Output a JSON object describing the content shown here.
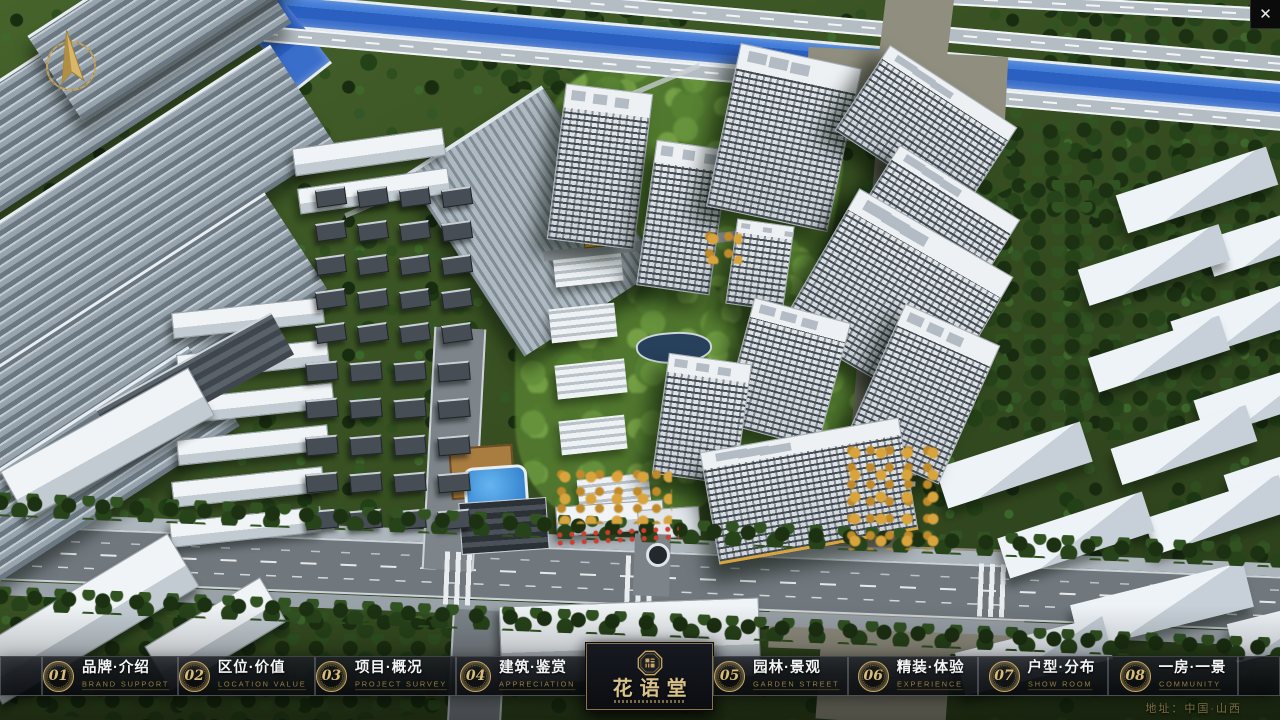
{
  "app": {
    "kind": "real-estate masterplan presentation"
  },
  "colors": {
    "accent_gold": "#c9ab66",
    "nav_bg": "#14171c",
    "title_text": "#f4f5f6",
    "subtitle_text": "#97803f",
    "river_blue": "#2b5fc0",
    "logo_gold": "#d8c289"
  },
  "nav": {
    "items": [
      {
        "num": "01",
        "title": "品牌·介绍",
        "subtitle": "BRAND SUPPORT"
      },
      {
        "num": "02",
        "title": "区位·价值",
        "subtitle": "LOCATION VALUE"
      },
      {
        "num": "03",
        "title": "项目·概况",
        "subtitle": "PROJECT SURVEY"
      },
      {
        "num": "04",
        "title": "建筑·鉴赏",
        "subtitle": "APPRECIATION"
      },
      {
        "num": "05",
        "title": "园林·景观",
        "subtitle": "GARDEN STREET"
      },
      {
        "num": "06",
        "title": "精装·体验",
        "subtitle": "EXPERIENCE"
      },
      {
        "num": "07",
        "title": "户型·分布",
        "subtitle": "SHOW ROOM"
      },
      {
        "num": "08",
        "title": "一房·一景",
        "subtitle": "COMMUNITY"
      }
    ]
  },
  "logo": {
    "title": "花语堂"
  },
  "footer": {
    "address": "地址：中国·山西"
  },
  "window": {
    "close_label": "✕"
  }
}
